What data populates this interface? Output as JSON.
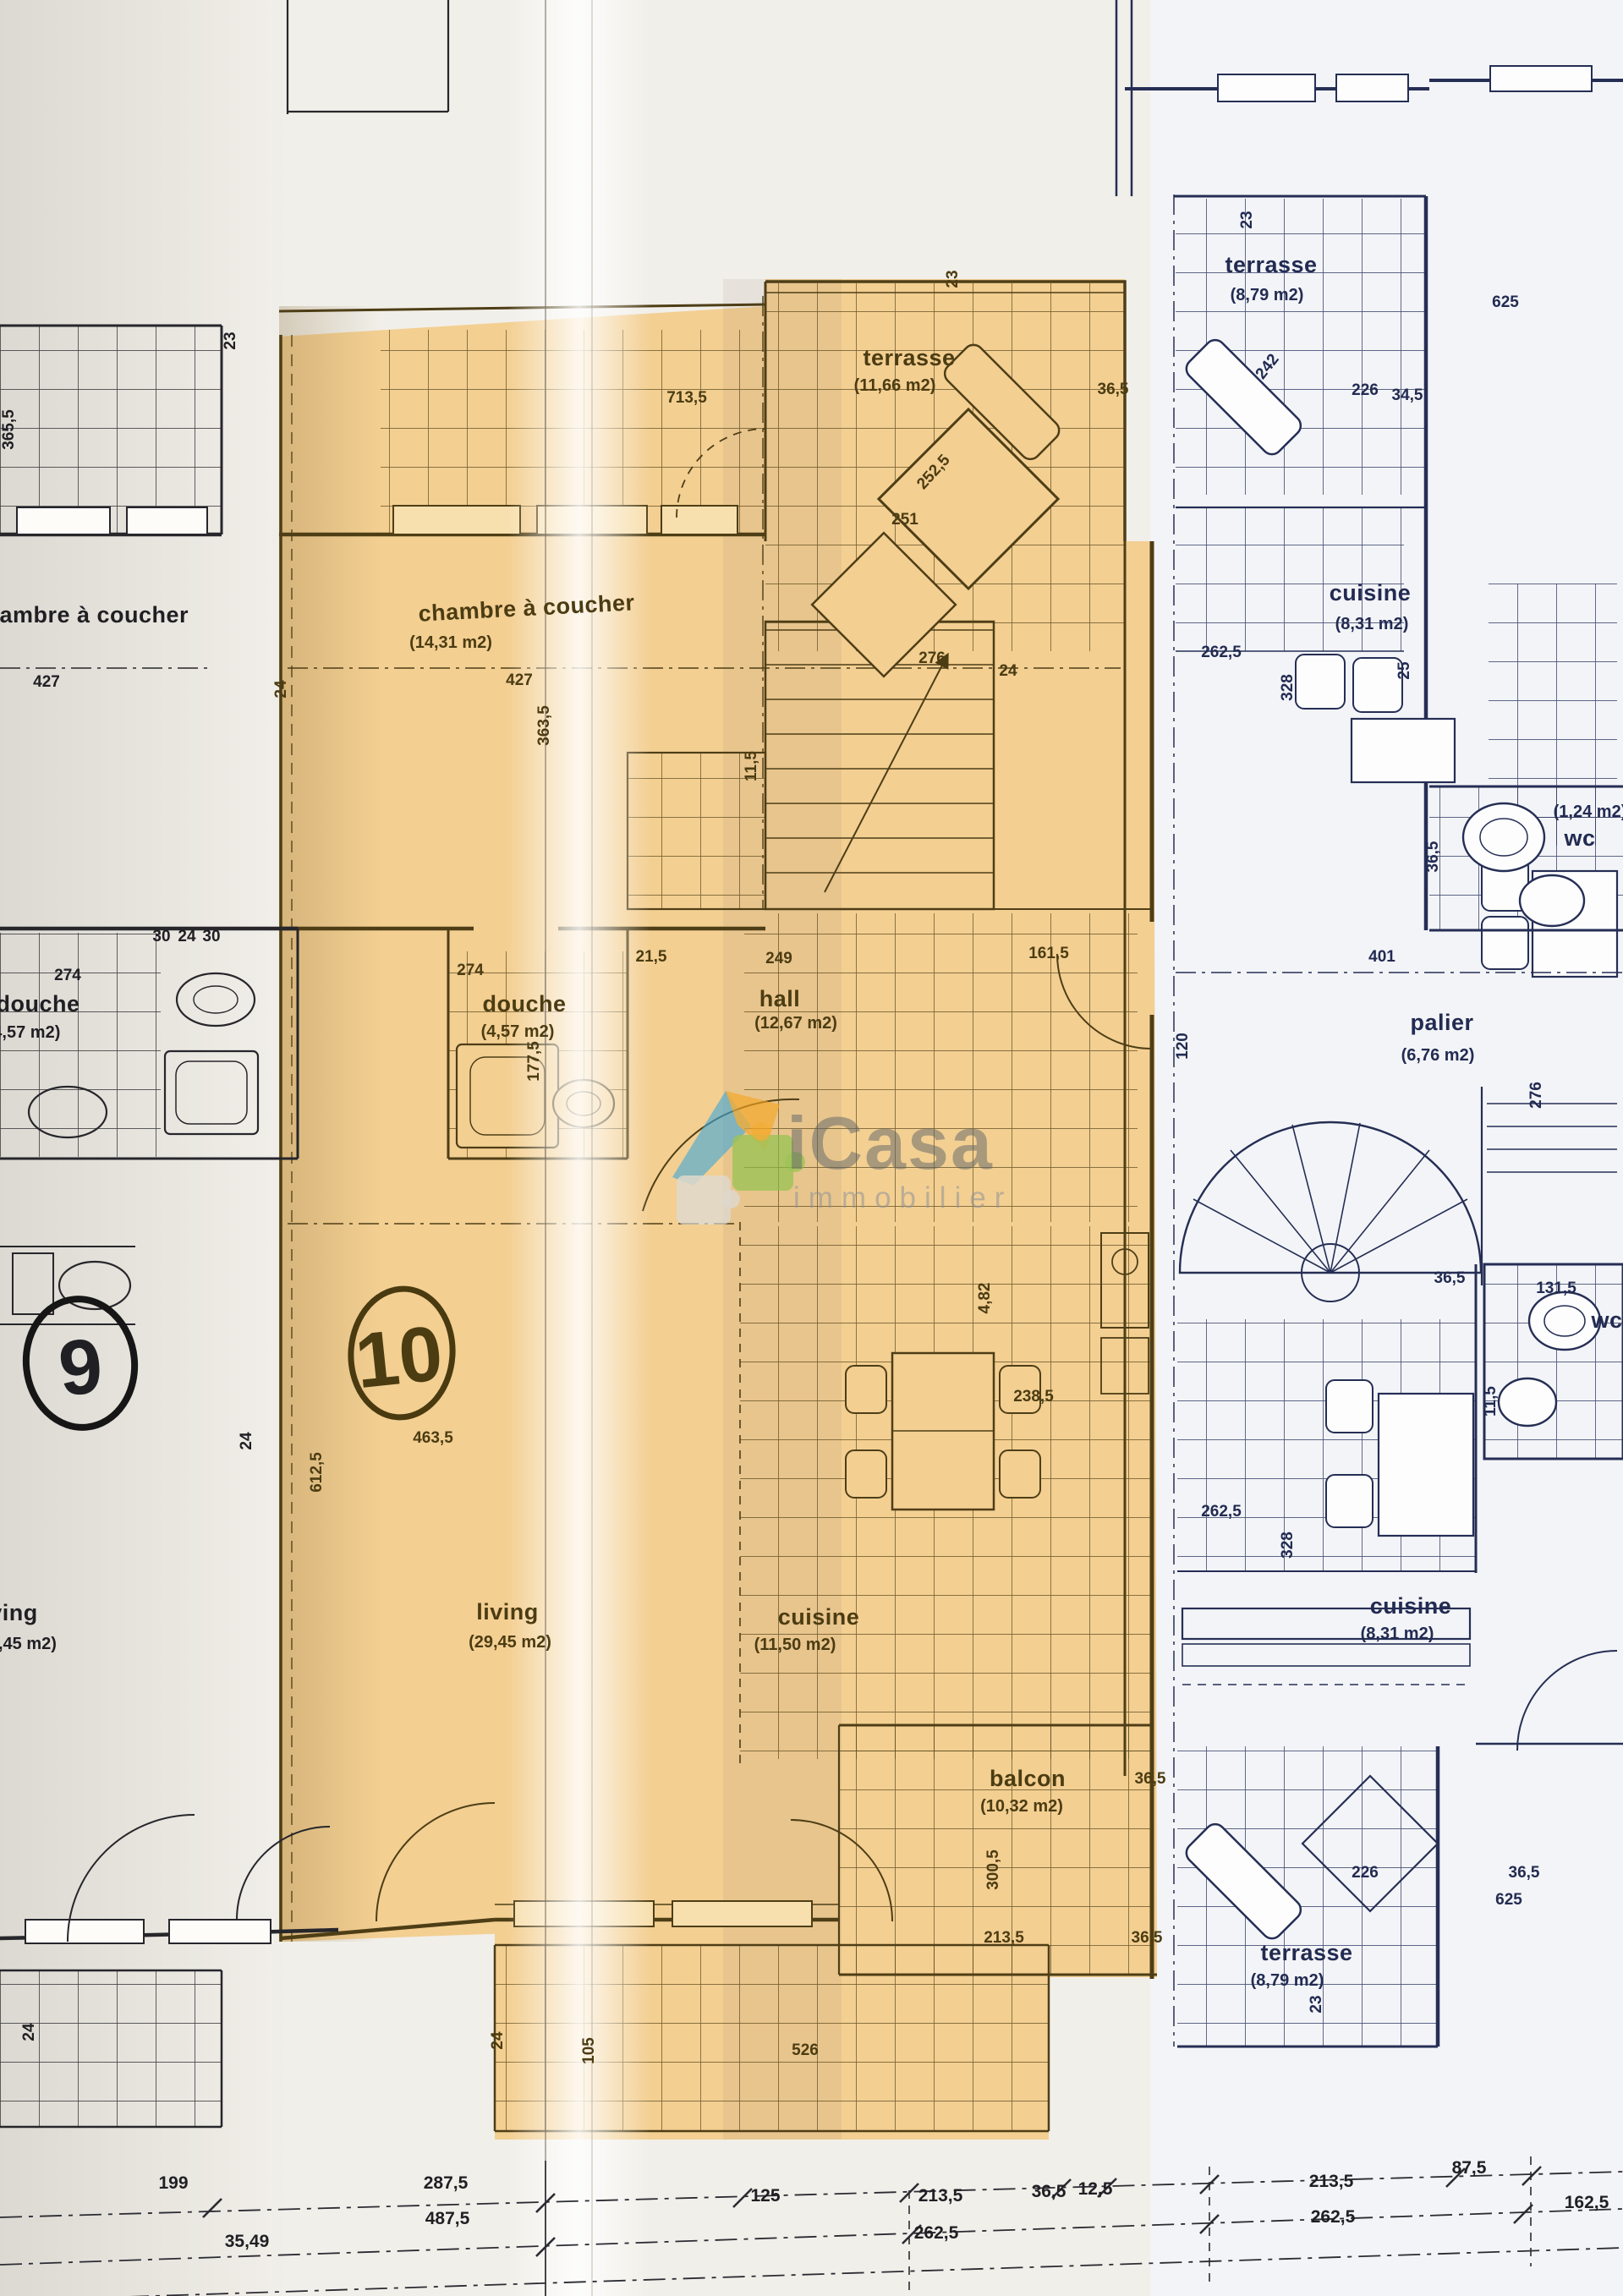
{
  "watermark": {
    "brand": "iCasa",
    "subtitle": "immobilier"
  },
  "units": {
    "left": "9",
    "highlighted": "10"
  },
  "rooms": {
    "u10_terrasse": {
      "name": "terrasse",
      "area": "(11,66 m2)"
    },
    "u10_chambre": {
      "name": "chambre à coucher",
      "area": "(14,31 m2)"
    },
    "u10_douche": {
      "name": "douche",
      "area": "(4,57 m2)"
    },
    "u10_hall": {
      "name": "hall",
      "area": "(12,67 m2)"
    },
    "u10_living": {
      "name": "living",
      "area": "(29,45 m2)"
    },
    "u10_cuisine": {
      "name": "cuisine",
      "area": "(11,50 m2)"
    },
    "u10_balcon": {
      "name": "balcon",
      "area": "(10,32 m2)"
    },
    "u9_chambre": {
      "name": "chambre à coucher",
      "area": "(14,31 m2)"
    },
    "u9_douche": {
      "name": "douche",
      "area": "(4,57 m2)"
    },
    "u9_living": {
      "name": "living",
      "area": "(29,45 m2)"
    },
    "r_terrasse_top": {
      "name": "terrasse",
      "area": "(8,79 m2)"
    },
    "r_cuisine_top": {
      "name": "cuisine",
      "area": "(8,31 m2)"
    },
    "r_wc_top": {
      "name": "wc",
      "area": "(1,24 m2)"
    },
    "r_palier": {
      "name": "palier",
      "area": "(6,76 m2)"
    },
    "r_wc_low": {
      "name": "wc"
    },
    "r_cuisine_low": {
      "name": "cuisine",
      "area": "(8,31 m2)"
    },
    "r_terrasse_low": {
      "name": "terrasse",
      "area": "(8,79 m2)"
    }
  },
  "dims": {
    "v23": "23",
    "v24": "24",
    "v25": "25",
    "v30": "30",
    "v34_5": "34,5",
    "v36_5": "36,5",
    "v105": "105",
    "v11_5": "11,5",
    "v120": "120",
    "v125": "125",
    "v12_5": "12,5",
    "v131_5": "131,5",
    "v161_5": "161,5",
    "v162_5": "162,5",
    "v177_5": "177,5",
    "v199": "199",
    "v213_5": "213,5",
    "v21_5": "21,5",
    "v226": "226",
    "v238_5": "238,5",
    "v242": "242",
    "v249": "249",
    "v251": "251",
    "v252_5": "252,5",
    "v262_5": "262,5",
    "v274": "274",
    "v276": "276",
    "v287_5": "287,5",
    "v300_5": "300,5",
    "v328": "328",
    "v35_49": "35,49",
    "v363_5": "363,5",
    "v365_5": "365,5",
    "v401": "401",
    "v427": "427",
    "v463_5": "463,5",
    "v487_5": "487,5",
    "v4_82": "4,82",
    "v526": "526",
    "v612_5": "612,5",
    "v625": "625",
    "v713_5": "713,5",
    "v87_5": "87,5"
  }
}
